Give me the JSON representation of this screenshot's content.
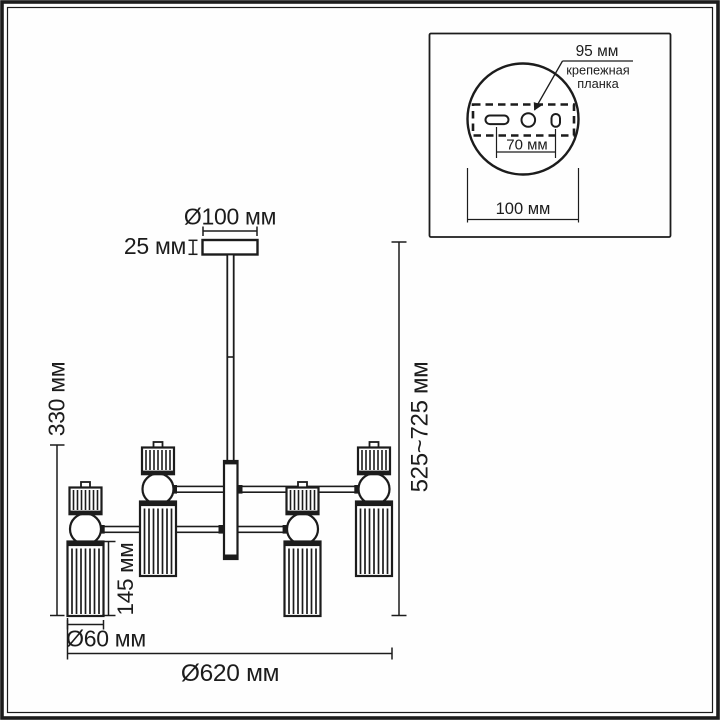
{
  "page": {
    "background": "#fefefe",
    "line_color": "#1c1c1c",
    "description_labels_language": "ru"
  },
  "main_drawing": {
    "dim_canopy_diameter": "Ø100 мм",
    "dim_canopy_height": "25 мм",
    "dim_body_height": "330 мм",
    "dim_overall_height": "525~725 мм",
    "dim_lower_shade_height": "145 мм",
    "dim_shade_diameter": "Ø60 мм",
    "dim_overall_diameter": "Ø620 мм"
  },
  "inset": {
    "dim_plate_length": "95 мм",
    "plate_caption_line1": "крепежная",
    "plate_caption_line2": "планка",
    "dim_hole_spacing": "70 мм",
    "dim_base_width": "100 мм"
  }
}
